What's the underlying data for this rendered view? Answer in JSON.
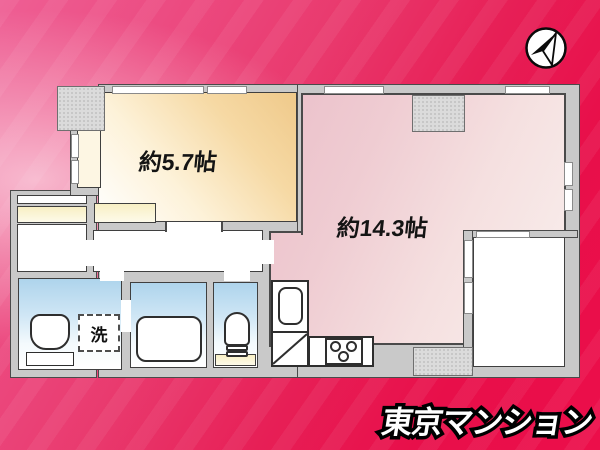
{
  "branding": {
    "logo_text": "東京マンション",
    "logo_fill": "#ffffff",
    "logo_outline": "#000000"
  },
  "compass": {
    "icon": "north-arrow-compass"
  },
  "palette": {
    "background_crimson": "#e80f4a",
    "background_pink_highlight": "#f6aac6",
    "wall_fill": "#c9c9c9",
    "wall_line": "#4a4a4a",
    "room_57_gradient_from": "#ffffff",
    "room_57_gradient_to": "#efc98a",
    "room_143_gradient_from": "#ebc0ca",
    "room_143_gradient_to": "#f9efed",
    "wet_area_blue": "#aed4ec",
    "closet_cream": "#f8efc4"
  },
  "rooms": {
    "western": {
      "label": "約5.7帖"
    },
    "living": {
      "label": "約14.3帖"
    },
    "laundry_box": {
      "label": "洗"
    }
  }
}
